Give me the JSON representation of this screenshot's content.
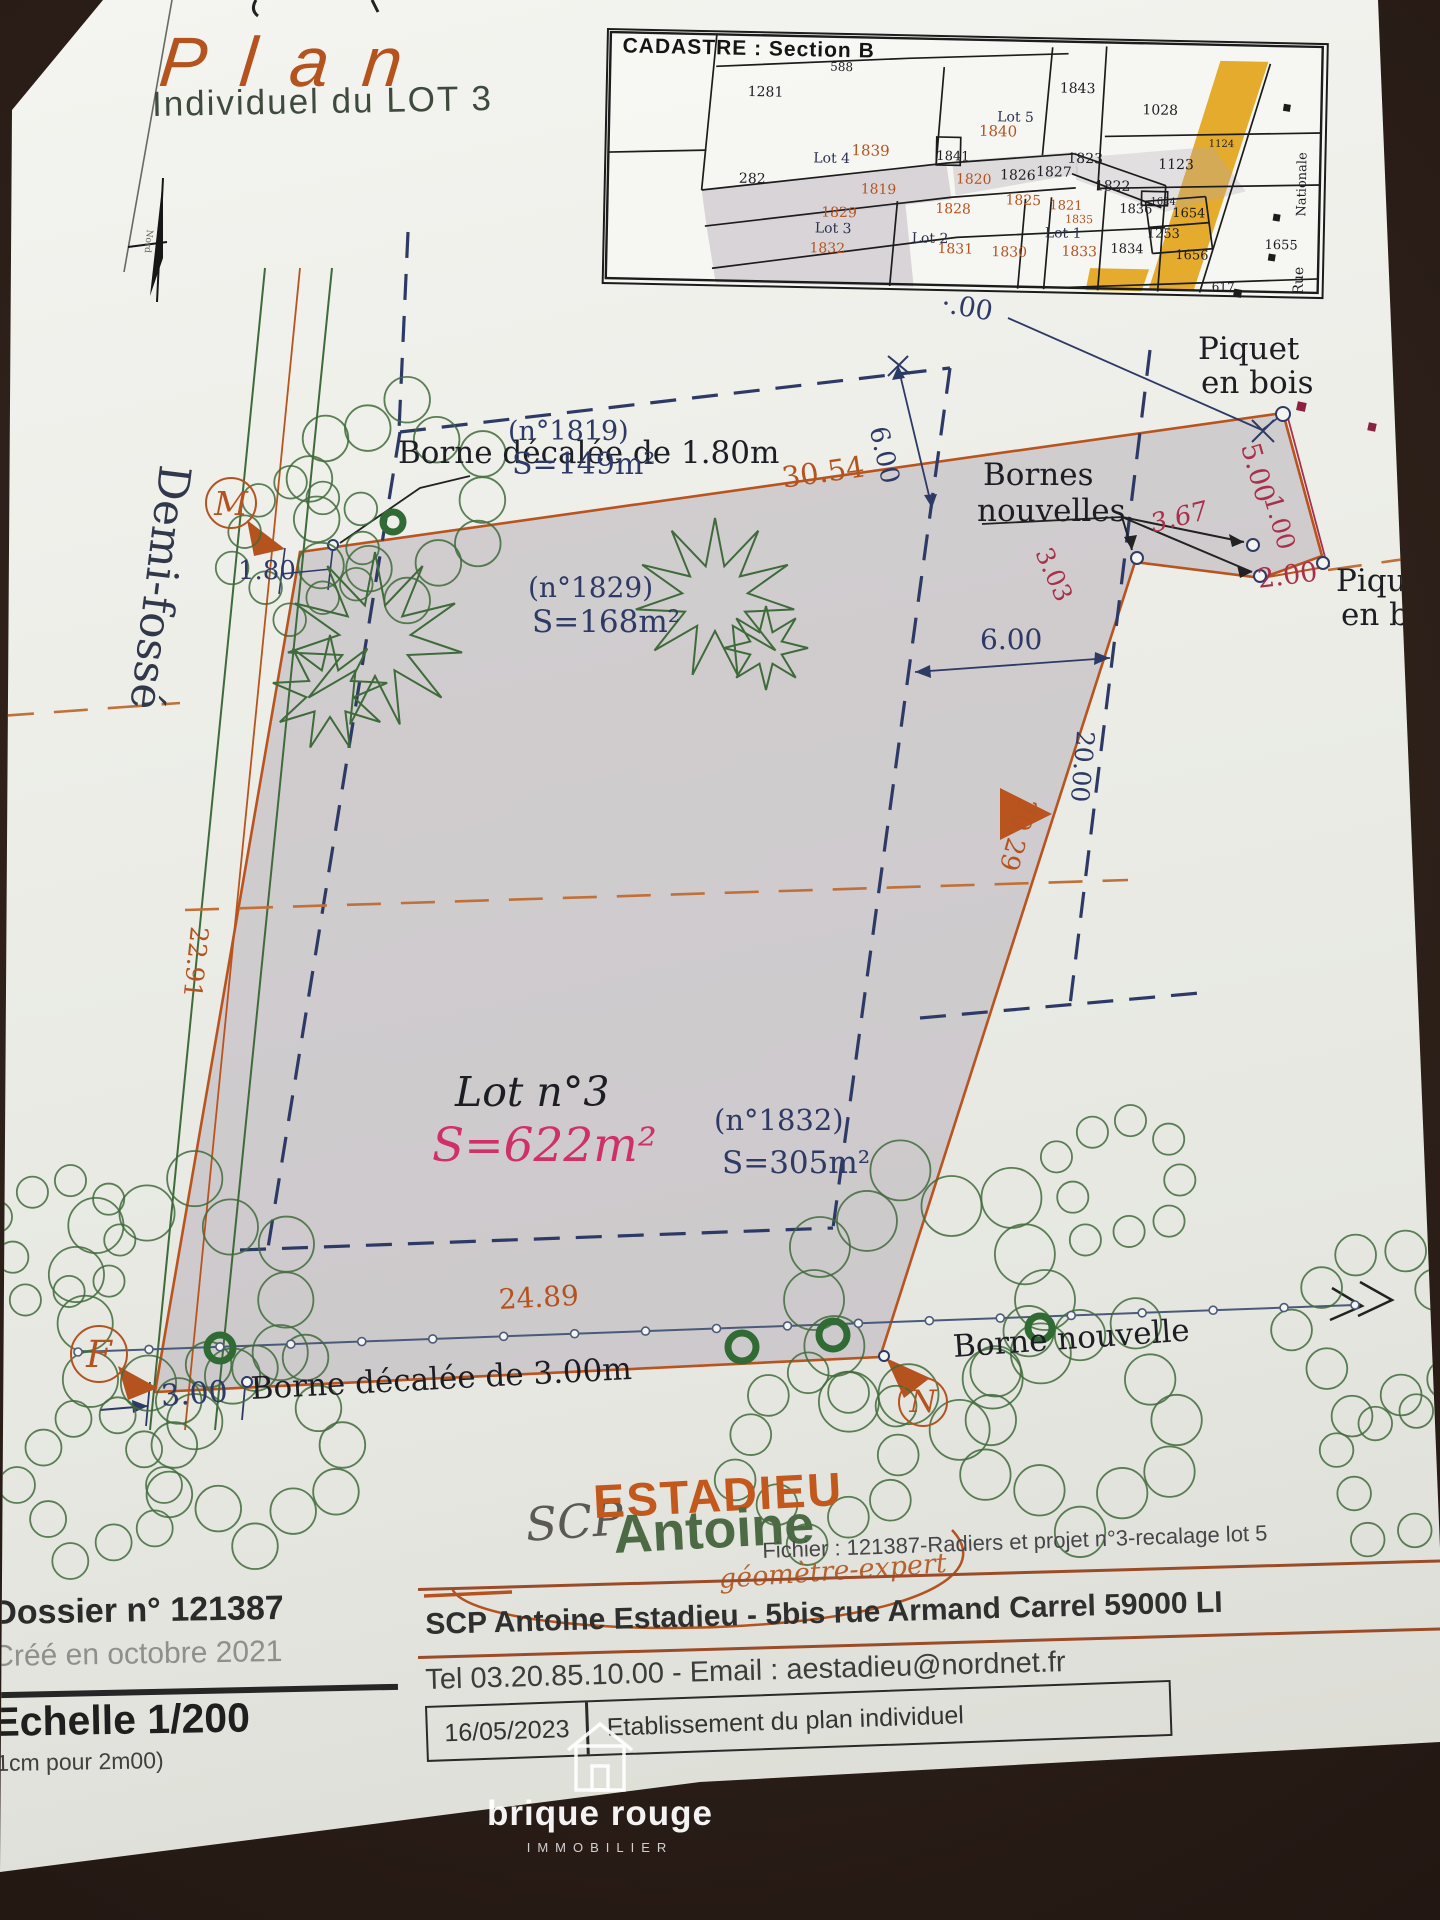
{
  "title": {
    "main": "Plan",
    "sub": "Individuel du LOT 3"
  },
  "cadastre": {
    "title": "CADASTRE : Section B",
    "street_vertical": [
      "Nationale",
      "Rue"
    ],
    "labels": [
      {
        "t": "588",
        "x": 222,
        "y": 26,
        "c": "k",
        "fs": 12
      },
      {
        "t": "1281",
        "x": 140,
        "y": 52,
        "c": "k",
        "fs": 14
      },
      {
        "t": "1843",
        "x": 452,
        "y": 42,
        "c": "k",
        "fs": 14
      },
      {
        "t": "1028",
        "x": 535,
        "y": 62,
        "c": "k",
        "fs": 14
      },
      {
        "t": "Lot 5",
        "x": 390,
        "y": 72,
        "c": "L",
        "fs": 14
      },
      {
        "t": "1840",
        "x": 372,
        "y": 86,
        "c": "o",
        "fs": 15
      },
      {
        "t": "Lot 4",
        "x": 207,
        "y": 117,
        "c": "L",
        "fs": 14
      },
      {
        "t": "1839",
        "x": 245,
        "y": 108,
        "c": "o",
        "fs": 15
      },
      {
        "t": "1841",
        "x": 330,
        "y": 113,
        "c": "k",
        "fs": 13
      },
      {
        "t": "1823",
        "x": 461,
        "y": 112,
        "c": "k",
        "fs": 14
      },
      {
        "t": "1123",
        "x": 552,
        "y": 116,
        "c": "k",
        "fs": 14
      },
      {
        "t": "1124",
        "x": 602,
        "y": 97,
        "c": "k",
        "fs": 10
      },
      {
        "t": "282",
        "x": 133,
        "y": 139,
        "c": "k",
        "fs": 14
      },
      {
        "t": "1819",
        "x": 255,
        "y": 147,
        "c": "o",
        "fs": 14
      },
      {
        "t": "1820",
        "x": 350,
        "y": 135,
        "c": "o",
        "fs": 14
      },
      {
        "t": "1826",
        "x": 394,
        "y": 130,
        "c": "k",
        "fs": 14
      },
      {
        "t": "1827",
        "x": 430,
        "y": 126,
        "c": "k",
        "fs": 14
      },
      {
        "t": "1822",
        "x": 489,
        "y": 139,
        "c": "k",
        "fs": 14
      },
      {
        "t": "1829",
        "x": 216,
        "y": 171,
        "c": "o",
        "fs": 14
      },
      {
        "t": "1828",
        "x": 330,
        "y": 165,
        "c": "o",
        "fs": 14
      },
      {
        "t": "1825",
        "x": 400,
        "y": 155,
        "c": "o",
        "fs": 14
      },
      {
        "t": "1821",
        "x": 444,
        "y": 160,
        "c": "o",
        "fs": 13
      },
      {
        "t": "1835",
        "x": 460,
        "y": 174,
        "c": "o",
        "fs": 11
      },
      {
        "t": "1836",
        "x": 514,
        "y": 162,
        "c": "k",
        "fs": 13
      },
      {
        "t": "1624",
        "x": 545,
        "y": 156,
        "c": "k",
        "fs": 10
      },
      {
        "t": "1654",
        "x": 567,
        "y": 165,
        "c": "k",
        "fs": 13
      },
      {
        "t": "Lot 3",
        "x": 210,
        "y": 187,
        "c": "L",
        "fs": 14
      },
      {
        "t": "Lot 2",
        "x": 307,
        "y": 195,
        "c": "L",
        "fs": 14
      },
      {
        "t": "Lot 1",
        "x": 440,
        "y": 187,
        "c": "L",
        "fs": 14
      },
      {
        "t": "1253",
        "x": 542,
        "y": 186,
        "c": "k",
        "fs": 13
      },
      {
        "t": "1832",
        "x": 205,
        "y": 207,
        "c": "o",
        "fs": 14
      },
      {
        "t": "1831",
        "x": 333,
        "y": 205,
        "c": "o",
        "fs": 14
      },
      {
        "t": "1830",
        "x": 387,
        "y": 207,
        "c": "o",
        "fs": 14
      },
      {
        "t": "1833",
        "x": 457,
        "y": 205,
        "c": "o",
        "fs": 14
      },
      {
        "t": "1834",
        "x": 506,
        "y": 202,
        "c": "k",
        "fs": 13
      },
      {
        "t": "1656",
        "x": 571,
        "y": 207,
        "c": "k",
        "fs": 13
      },
      {
        "t": "1655",
        "x": 660,
        "y": 195,
        "c": "k",
        "fs": 13
      },
      {
        "t": "617",
        "x": 608,
        "y": 238,
        "c": "k",
        "fs": 12
      },
      {
        "t": "Nationale",
        "x": 690,
        "y": 172,
        "c": "k",
        "fs": 13,
        "rot": -90
      },
      {
        "t": "Rue",
        "x": 688,
        "y": 250,
        "c": "k",
        "fs": 14,
        "rot": -90
      }
    ]
  },
  "plan": {
    "labels": [
      {
        "t": "Borne décalée de 1.80m",
        "x": 398,
        "y": 438,
        "fs": 31,
        "c": "k"
      },
      {
        "t": "(n°1819)",
        "x": 508,
        "y": 418,
        "fs": 27,
        "c": "n"
      },
      {
        "t": "S=149m²",
        "x": 512,
        "y": 450,
        "fs": 30,
        "c": "n"
      },
      {
        "t": "30.54",
        "x": 780,
        "y": 464,
        "fs": 29,
        "c": "o",
        "rot": -8
      },
      {
        "t": "6.00",
        "x": 890,
        "y": 424,
        "fs": 26,
        "c": "n",
        "rot": 77
      },
      {
        "t": "·.00",
        "x": 944,
        "y": 290,
        "fs": 27,
        "c": "n",
        "rot": 10
      },
      {
        "t": "Piquet",
        "x": 1198,
        "y": 334,
        "fs": 31,
        "c": "k"
      },
      {
        "t": "en bois",
        "x": 1201,
        "y": 368,
        "fs": 31,
        "c": "k"
      },
      {
        "t": "Bornes",
        "x": 983,
        "y": 460,
        "fs": 31,
        "c": "k"
      },
      {
        "t": "nouvelles",
        "x": 977,
        "y": 496,
        "fs": 31,
        "c": "k"
      },
      {
        "t": "5.00",
        "x": 1262,
        "y": 440,
        "fs": 27,
        "c": "r",
        "rot": 74
      },
      {
        "t": "1.00",
        "x": 1284,
        "y": 492,
        "fs": 25,
        "c": "r",
        "rot": 74
      },
      {
        "t": "2.00",
        "x": 1256,
        "y": 566,
        "fs": 27,
        "c": "r",
        "rot": -7
      },
      {
        "t": "Piquet",
        "x": 1336,
        "y": 566,
        "fs": 31,
        "c": "k"
      },
      {
        "t": "en bois",
        "x": 1341,
        "y": 600,
        "fs": 31,
        "c": "k"
      },
      {
        "t": "3.67",
        "x": 1148,
        "y": 512,
        "fs": 26,
        "c": "r",
        "rot": -14,
        "it": 1
      },
      {
        "t": "3.03",
        "x": 1054,
        "y": 544,
        "fs": 25,
        "c": "r",
        "rot": 66
      },
      {
        "t": "(n°1829)",
        "x": 528,
        "y": 574,
        "fs": 28,
        "c": "n"
      },
      {
        "t": "S=168m²",
        "x": 532,
        "y": 607,
        "fs": 31,
        "c": "n"
      },
      {
        "t": "6.00",
        "x": 980,
        "y": 626,
        "fs": 28,
        "c": "n"
      },
      {
        "t": "20.00",
        "x": 1098,
        "y": 732,
        "fs": 25,
        "c": "n",
        "rot": 95
      },
      {
        "t": "20.29",
        "x": 1040,
        "y": 802,
        "fs": 26,
        "c": "o",
        "rot": 106
      },
      {
        "t": "Demi-fossé",
        "x": 196,
        "y": 468,
        "fs": 44,
        "c": "d",
        "rot": 97
      },
      {
        "t": "22.91",
        "x": 212,
        "y": 928,
        "fs": 25,
        "c": "o",
        "rot": 96
      },
      {
        "t": "1.80",
        "x": 238,
        "y": 558,
        "fs": 26,
        "c": "n"
      },
      {
        "t": "Lot n°3",
        "x": 455,
        "y": 1072,
        "fs": 41,
        "c": "k",
        "it": 1
      },
      {
        "t": "S=622m²",
        "x": 432,
        "y": 1122,
        "fs": 47,
        "c": "p",
        "it": 1
      },
      {
        "t": "(n°1832)",
        "x": 714,
        "y": 1106,
        "fs": 29,
        "c": "n"
      },
      {
        "t": "S=305m²",
        "x": 722,
        "y": 1148,
        "fs": 31,
        "c": "n"
      },
      {
        "t": "24.89",
        "x": 498,
        "y": 1286,
        "fs": 28,
        "c": "o",
        "rot": -3
      },
      {
        "t": "3.00",
        "x": 160,
        "y": 1382,
        "fs": 30,
        "c": "n",
        "rot": -4
      },
      {
        "t": "Borne décalée de 3.00m",
        "x": 250,
        "y": 1374,
        "fs": 31,
        "c": "k",
        "rot": -3
      },
      {
        "t": "Borne nouvelle",
        "x": 952,
        "y": 1332,
        "fs": 31,
        "c": "k",
        "rot": -4
      },
      {
        "t": "Nord",
        "x": 153,
        "y": 230,
        "fs": 9,
        "c": "g",
        "rot": 96
      }
    ],
    "medallions": [
      {
        "letter": "M",
        "x": 205,
        "y": 477,
        "d": 48
      },
      {
        "letter": "F",
        "x": 70,
        "y": 1325,
        "d": 54
      },
      {
        "letter": "N",
        "x": 898,
        "y": 1377,
        "d": 46
      }
    ]
  },
  "footer": {
    "dossier": "Dossier n° 121387",
    "created": "Créé en octobre 2021",
    "scale": "Echelle 1/200",
    "scale_sub": "1cm pour 2m00)",
    "logo": {
      "scp": "SCP",
      "name1": "ESTADIEU",
      "name2": "Antoine",
      "tagline": "géomètre-expert"
    },
    "fichier": "Fichier : 121387-Radiers et projet n°3-recalage lot 5",
    "address": "SCP Antoine Estadieu - 5bis rue Armand Carrel 59000 LI",
    "contact": "Tel 03.20.85.10.00 - Email : aestadieu@nordnet.fr",
    "date": "16/05/2023",
    "doc_label": "Etablissement du plan individuel"
  },
  "watermark": {
    "line1": "brique rouge",
    "line2": "IMMOBILIER"
  },
  "colors": {
    "orange": "#b5531f",
    "navy": "#2e3a66",
    "red": "#a8304a",
    "pink": "#cf3069",
    "black": "#1d1d24",
    "gray": "#62625c",
    "green": "#3f6b3a",
    "lotblue": "#2a3050",
    "demifosse": "#32384c",
    "parcel_fill": "#b7aeb9",
    "road_yellow": "#e2a41c"
  }
}
